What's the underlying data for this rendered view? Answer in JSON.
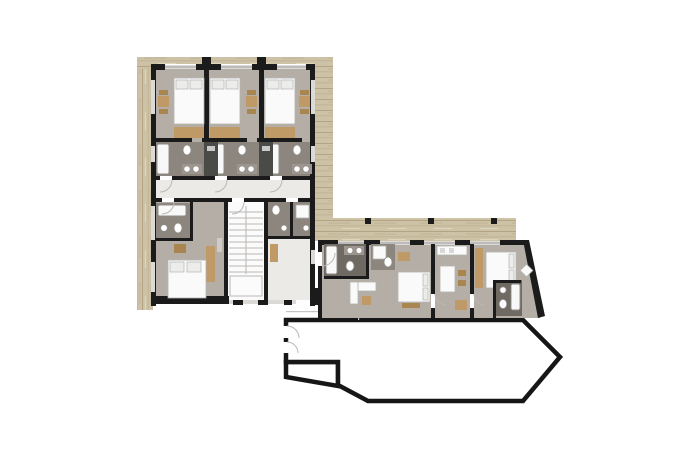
{
  "canvas": {
    "width": 700,
    "height": 467,
    "background": "#ffffff"
  },
  "colors": {
    "wall": "#1b1b1b",
    "outline_stroke": "#161616",
    "wood_base": "#cdc2a6",
    "wood_grain": "#b1a183",
    "wood_grain_light": "#ded5bd",
    "room_floor": "#b5aea6",
    "room_floor_light": "#c8c2bb",
    "bath_floor": "#8c867f",
    "bath_floor_dark": "#6f6963",
    "corridor_floor": "#eceae7",
    "stair_floor": "#fbfbfb",
    "furniture_white": "#fafafa",
    "furniture_outline": "#b2b2b0",
    "furniture_wood": "#c09a66",
    "furniture_wood_dark": "#a9854f",
    "shaft_dark": "#4a4a47",
    "window_fill": "#dcdad7",
    "window_line": "#9e9e9e",
    "thin_line": "#b9b7b4"
  },
  "floorplan": {
    "type": "architectural-floor-plan",
    "blocks": [
      {
        "id": "guest-room-block",
        "rooms": [
          "guest-room-1",
          "guest-room-2",
          "guest-room-3",
          "guest-room-4",
          "stairwell",
          "service-rooms"
        ]
      },
      {
        "id": "apartment-wing",
        "rooms": [
          "bathroom-1",
          "shower-room",
          "living-room",
          "kitchen",
          "bedroom-1",
          "bedroom-2",
          "bathroom-2"
        ]
      },
      {
        "id": "ground-outline",
        "rooms": []
      }
    ],
    "deck": {
      "material": "wood",
      "location": "wraps guest-room block and runs along top of apartment wing"
    }
  }
}
